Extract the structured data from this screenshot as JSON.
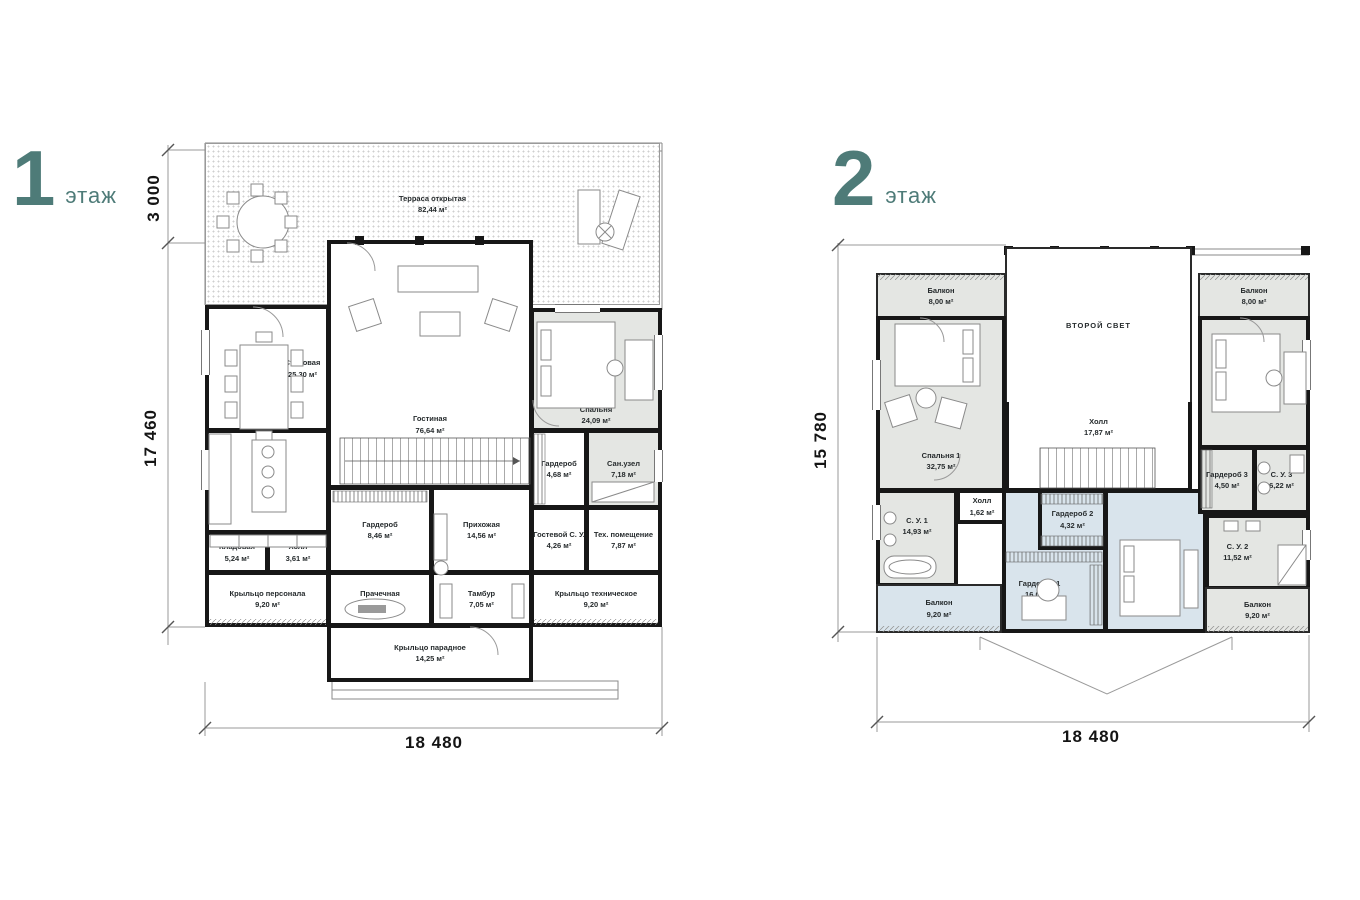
{
  "colors": {
    "accent": "#4e7b78",
    "room_gray": "#e4e6e3",
    "room_blue": "#d9e4ec",
    "wall": "#171717"
  },
  "floor1": {
    "title_number": "1",
    "title_word": "этаж",
    "dims": {
      "terrace_height": "3 000",
      "height": "17 460",
      "width": "18 480"
    },
    "rooms": [
      {
        "name": "Терраса открытая",
        "area": "82,44 м²"
      },
      {
        "name": "Столовая",
        "area": "25,30 м²"
      },
      {
        "name": "Гостиная",
        "area": "76,64 м²"
      },
      {
        "name": "Спальня",
        "area": "24,09 м²"
      },
      {
        "name": "Гардероб",
        "area": "4,68 м²"
      },
      {
        "name": "Сан.узел",
        "area": "7,18 м²"
      },
      {
        "name": "Кухня",
        "area": "16,75 м²"
      },
      {
        "name": "Гардероб",
        "area": "8,46 м²"
      },
      {
        "name": "Прихожая",
        "area": "14,56 м²"
      },
      {
        "name": "Гостевой С. У.",
        "area": "4,26 м²"
      },
      {
        "name": "Тех. помещение",
        "area": "7,87 м²"
      },
      {
        "name": "Кладовая",
        "area": "5,24 м²"
      },
      {
        "name": "Холл",
        "area": "3,61 м²"
      },
      {
        "name": "Прачечная",
        "area": "12,03 м²"
      },
      {
        "name": "Тамбур",
        "area": "7,05 м²"
      },
      {
        "name": "Крыльцо персонала",
        "area": "9,20 м²"
      },
      {
        "name": "Крыльцо техническое",
        "area": "9,20 м²"
      },
      {
        "name": "Крыльцо парадное",
        "area": "14,25 м²"
      }
    ]
  },
  "floor2": {
    "title_number": "2",
    "title_word": "этаж",
    "dims": {
      "height": "15 780",
      "width": "18 480"
    },
    "rooms": [
      {
        "name": "Балкон",
        "area": "8,00 м²"
      },
      {
        "name": "ВТОРОЙ СВЕТ",
        "area": ""
      },
      {
        "name": "Балкон",
        "area": "8,00 м²"
      },
      {
        "name": "Спальня 1",
        "area": "32,75 м²"
      },
      {
        "name": "Спальня 3",
        "area": "24,09 м²"
      },
      {
        "name": "Холл",
        "area": "17,87 м²"
      },
      {
        "name": "Холл",
        "area": "1,62 м²"
      },
      {
        "name": "С. У. 1",
        "area": "14,93 м²"
      },
      {
        "name": "Гардероб 2",
        "area": "4,32 м²"
      },
      {
        "name": "Гардероб 3",
        "area": "4,50 м²"
      },
      {
        "name": "С. У. 3",
        "area": "6,22 м²"
      },
      {
        "name": "Гардероб 1",
        "area": "16,06 м²"
      },
      {
        "name": "Спальня 2",
        "area": "21,26 м²"
      },
      {
        "name": "С. У. 2",
        "area": "11,52 м²"
      },
      {
        "name": "Балкон",
        "area": "9,20 м²"
      },
      {
        "name": "Балкон",
        "area": "9,20 м²"
      }
    ]
  }
}
